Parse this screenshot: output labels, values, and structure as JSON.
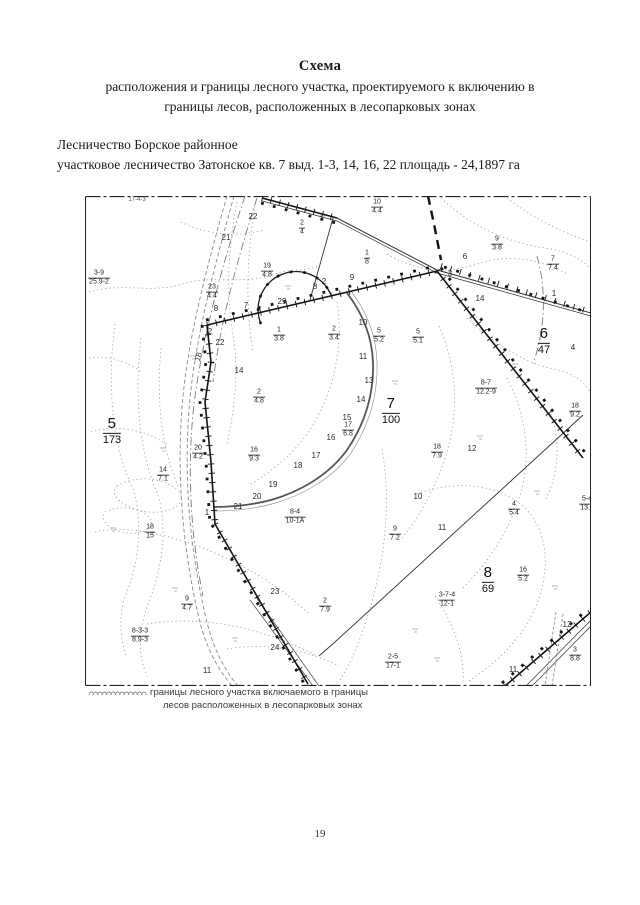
{
  "page": {
    "title": "Схема",
    "subtitle_line1": "расположения и границы лесного участка, проектируемого к включению в",
    "subtitle_line2": "границы лесов, расположенных в лесопарковых зонах",
    "header_line1": "Лесничество Борское районное",
    "header_line2": "участковое лесничество Затонское кв. 7 выд. 1-3, 14, 16, 22 площадь - 24,1897 га",
    "page_number": "19"
  },
  "legend": {
    "symbol": "wavy-line",
    "line1": "границы лесного участка включаемого в границы",
    "line2": "лесов расположенных в лесопарковых зонах"
  },
  "colors": {
    "ink": "#141414",
    "contour_gray": "#9b9b9b"
  },
  "map": {
    "corner_note": "17-4-3",
    "quarter_labels": [
      {
        "num": "5",
        "den": "173",
        "x": 27,
        "y": 235
      },
      {
        "num": "6",
        "den": "47",
        "x": 459,
        "y": 145
      },
      {
        "num": "7",
        "den": "100",
        "x": 306,
        "y": 215
      },
      {
        "num": "8",
        "den": "69",
        "x": 403,
        "y": 384
      }
    ],
    "fraction_labels": [
      {
        "num": "3-9",
        "den": "25.9-2",
        "x": 14,
        "y": 82
      },
      {
        "num": "2",
        "den": "4",
        "x": 217,
        "y": 32
      },
      {
        "num": "10",
        "den": "4.4",
        "x": 292,
        "y": 11
      },
      {
        "num": "19",
        "den": "4.8",
        "x": 182,
        "y": 75
      },
      {
        "num": "23",
        "den": "4.4",
        "x": 127,
        "y": 96
      },
      {
        "num": "9",
        "den": "3.8",
        "x": 412,
        "y": 48
      },
      {
        "num": "7",
        "den": "7.4",
        "x": 468,
        "y": 68
      },
      {
        "num": "1",
        "den": "8",
        "x": 282,
        "y": 62
      },
      {
        "num": "1",
        "den": "3.8",
        "x": 194,
        "y": 139
      },
      {
        "num": "2",
        "den": "3.4",
        "x": 249,
        "y": 138
      },
      {
        "num": "5",
        "den": "5.2",
        "x": 294,
        "y": 140
      },
      {
        "num": "5",
        "den": "5.1",
        "x": 333,
        "y": 141
      },
      {
        "num": "2",
        "den": "4.8",
        "x": 174,
        "y": 201
      },
      {
        "num": "8-7",
        "den": "12.2-9",
        "x": 401,
        "y": 192
      },
      {
        "num": "17",
        "den": "6.8",
        "x": 263,
        "y": 234
      },
      {
        "num": "18",
        "den": "9.2",
        "x": 490,
        "y": 215
      },
      {
        "num": "16",
        "den": "9.3",
        "x": 169,
        "y": 259
      },
      {
        "num": "18",
        "den": "7.9",
        "x": 352,
        "y": 256
      },
      {
        "num": "20",
        "den": "4.2",
        "x": 113,
        "y": 257
      },
      {
        "num": "14",
        "den": "7.1",
        "x": 78,
        "y": 279
      },
      {
        "num": "8-4",
        "den": "10-1A",
        "x": 210,
        "y": 321
      },
      {
        "num": "18",
        "den": "15",
        "x": 65,
        "y": 336
      },
      {
        "num": "9",
        "den": "7.2",
        "x": 310,
        "y": 338
      },
      {
        "num": "4",
        "den": "5.4",
        "x": 429,
        "y": 313
      },
      {
        "num": "5-4",
        "den": "13.7",
        "x": 502,
        "y": 308
      },
      {
        "num": "2",
        "den": "7.9",
        "x": 240,
        "y": 410
      },
      {
        "num": "9",
        "den": "4.7",
        "x": 102,
        "y": 408
      },
      {
        "num": "8-3-3",
        "den": "8.9-3",
        "x": 55,
        "y": 440
      },
      {
        "num": "3-7-4",
        "den": "12-1",
        "x": 362,
        "y": 404
      },
      {
        "num": "16",
        "den": "5.2",
        "x": 438,
        "y": 379
      },
      {
        "num": "2-5",
        "den": "17-1",
        "x": 308,
        "y": 466
      },
      {
        "num": "3",
        "den": "8.8",
        "x": 490,
        "y": 459
      }
    ],
    "plain_labels": [
      {
        "t": "22",
        "x": 168,
        "y": 21
      },
      {
        "t": "21",
        "x": 141,
        "y": 42
      },
      {
        "t": "6",
        "x": 380,
        "y": 61
      },
      {
        "t": "3",
        "x": 365,
        "y": 78
      },
      {
        "t": "9",
        "x": 267,
        "y": 82
      },
      {
        "t": "2",
        "x": 239,
        "y": 86
      },
      {
        "t": "8",
        "x": 230,
        "y": 91
      },
      {
        "t": "29",
        "x": 197,
        "y": 106
      },
      {
        "t": "7",
        "x": 161,
        "y": 110
      },
      {
        "t": "8",
        "x": 131,
        "y": 113
      },
      {
        "t": "14",
        "x": 395,
        "y": 103
      },
      {
        "t": "1",
        "x": 469,
        "y": 98
      },
      {
        "t": "4",
        "x": 488,
        "y": 152
      },
      {
        "t": "2",
        "x": 125,
        "y": 136
      },
      {
        "t": "22",
        "x": 135,
        "y": 147
      },
      {
        "t": "18",
        "x": 114,
        "y": 161,
        "rot": -75
      },
      {
        "t": "14",
        "x": 154,
        "y": 175
      },
      {
        "t": "10",
        "x": 278,
        "y": 127
      },
      {
        "t": "11",
        "x": 278,
        "y": 161
      },
      {
        "t": "13",
        "x": 284,
        "y": 185
      },
      {
        "t": "14",
        "x": 276,
        "y": 204
      },
      {
        "t": "15",
        "x": 262,
        "y": 222
      },
      {
        "t": "16",
        "x": 246,
        "y": 242
      },
      {
        "t": "17",
        "x": 231,
        "y": 260
      },
      {
        "t": "18",
        "x": 213,
        "y": 270
      },
      {
        "t": "19",
        "x": 188,
        "y": 289
      },
      {
        "t": "20",
        "x": 172,
        "y": 301
      },
      {
        "t": "21",
        "x": 153,
        "y": 311
      },
      {
        "t": "1",
        "x": 122,
        "y": 317
      },
      {
        "t": "12",
        "x": 387,
        "y": 253
      },
      {
        "t": "10",
        "x": 333,
        "y": 301
      },
      {
        "t": "11",
        "x": 357,
        "y": 332
      },
      {
        "t": "23",
        "x": 190,
        "y": 396
      },
      {
        "t": "24",
        "x": 190,
        "y": 452
      },
      {
        "t": "11",
        "x": 122,
        "y": 475
      },
      {
        "t": "12",
        "x": 482,
        "y": 429
      },
      {
        "t": "11",
        "x": 428,
        "y": 474
      }
    ]
  }
}
